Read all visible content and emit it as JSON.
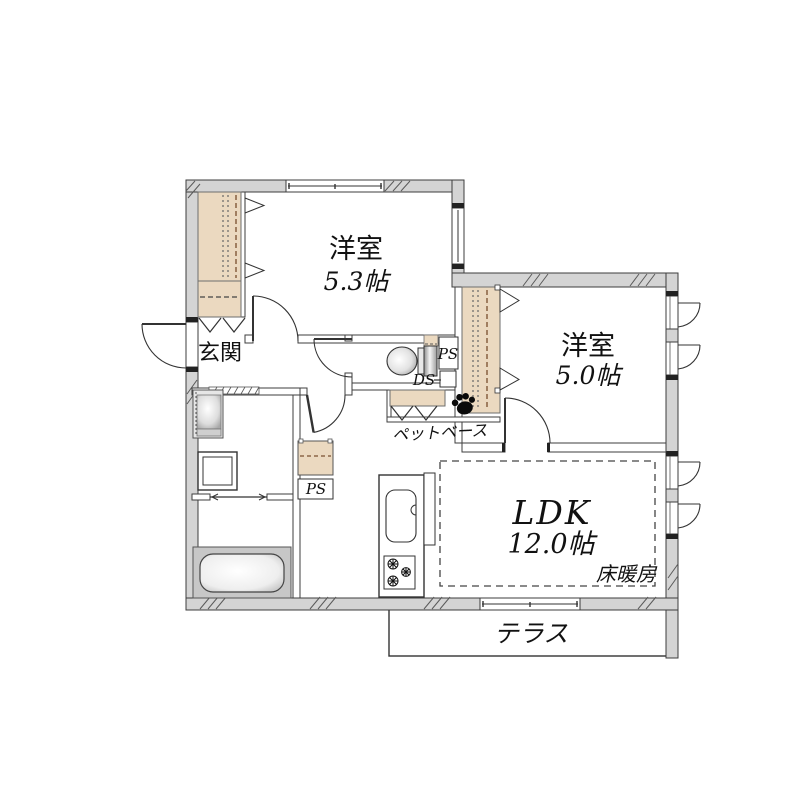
{
  "floorplan": {
    "rooms": {
      "western1": {
        "name": "洋室",
        "size": "5.3帖"
      },
      "western2": {
        "name": "洋室",
        "size": "5.0帖"
      },
      "ldk": {
        "name": "LDK",
        "size": "12.0帖",
        "floor_heating": "床暖房"
      },
      "entrance": {
        "name": "玄関"
      },
      "terrace": {
        "name": "テラス"
      },
      "pet_base": {
        "name": "ペットベース"
      }
    },
    "ducts": {
      "ps_toilet": "PS",
      "ds_toilet": "DS",
      "ps_hall": "PS"
    },
    "icons": {
      "paw": "paw-icon",
      "toilet": "toilet-icon",
      "bathtub": "bathtub-icon",
      "washbasin": "washbasin-icon",
      "washing_machine": "washing-machine-icon",
      "sink": "kitchen-sink-icon",
      "stove": "gas-stove-icon"
    },
    "colors": {
      "wall_fill": "#d4d4d4",
      "closet_fill": "#ebd9c0",
      "outline": "#3d3d3d",
      "background": "#ffffff"
    }
  }
}
